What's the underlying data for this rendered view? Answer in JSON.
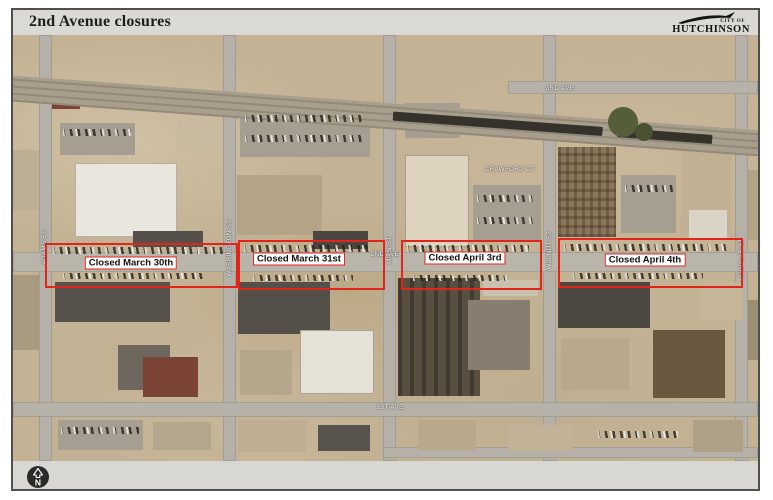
{
  "header": {
    "title": "2nd Avenue closures"
  },
  "logo": {
    "top_text": "CITY OF",
    "name": "HUTCHINSON"
  },
  "map": {
    "closures": [
      {
        "label": "Closed March 30th"
      },
      {
        "label": "Closed March 31st"
      },
      {
        "label": "Closed April 3rd"
      },
      {
        "label": "Closed April 4th"
      }
    ],
    "streets": {
      "adams": "ADAMS ST",
      "washington": "WASHINGTON ST",
      "main": "MAIN ST",
      "walnut": "WALNUT ST",
      "poplar": "POPLAR ST",
      "third_ave": "3RD AVE",
      "second_ave": "2ND AVE",
      "first_ave": "1ST AVE",
      "crawford": "CRAWFORD CT"
    },
    "north_label": "N"
  },
  "colors": {
    "closure_red": "#e1251b",
    "page_band": "#dbd9d4",
    "map_base": "#c4b294",
    "logo_black": "#141414"
  }
}
